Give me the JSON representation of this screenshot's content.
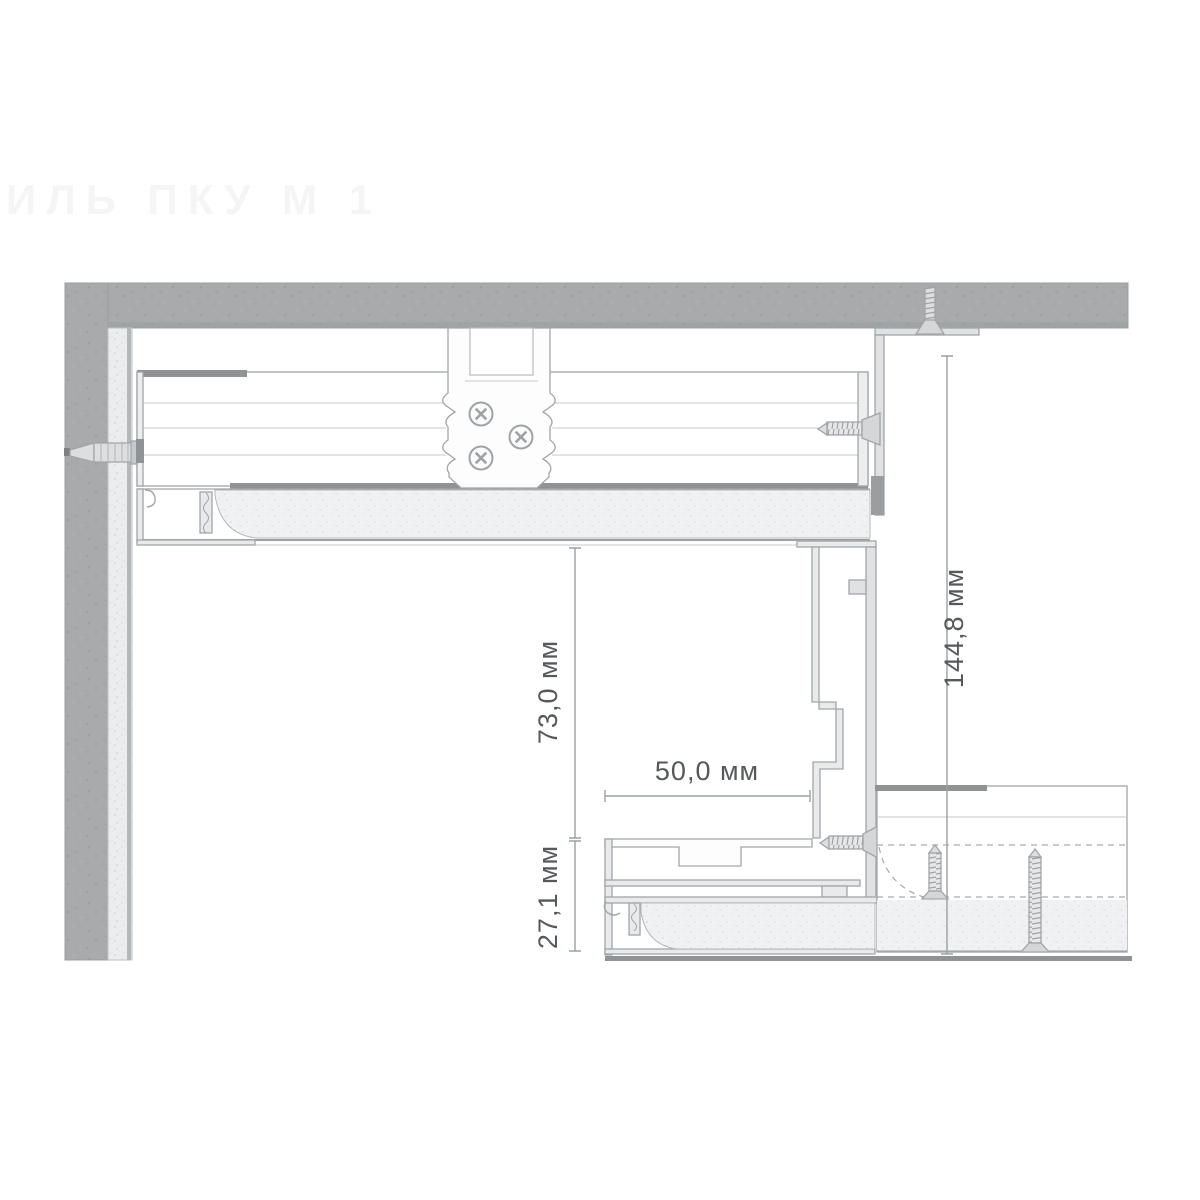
{
  "watermark": "ИЛЬ ПКУ М 1",
  "labels": {
    "dim_total_height": "144,8 мм",
    "dim_cavity_height": "73,0 мм",
    "dim_shelf_width": "50,0 мм",
    "dim_lower_height": "27,1 мм"
  },
  "colors": {
    "concrete": "#a8aaac",
    "gypsum": "#f0f1f2",
    "metal_light": "#e9eaeb",
    "metal_dark": "#8f9396",
    "outline": "#a2a6a9",
    "dimension_text": "#56595c"
  }
}
